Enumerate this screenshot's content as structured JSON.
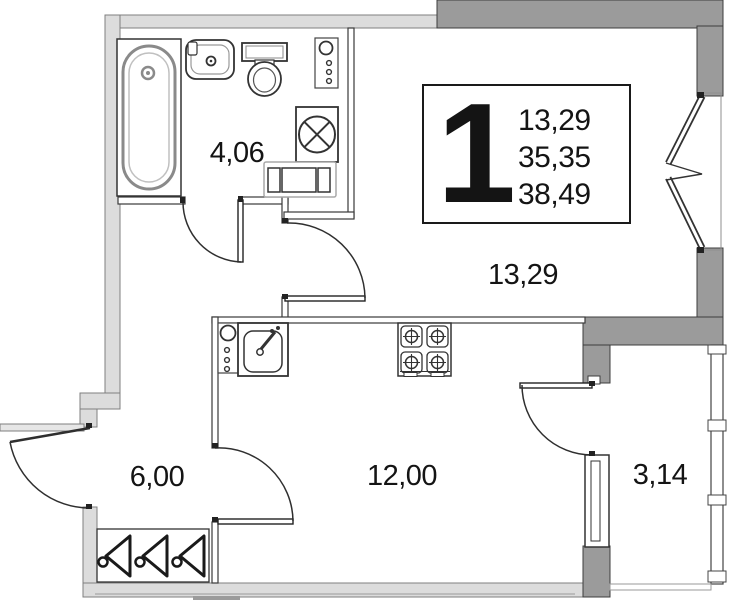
{
  "unit_card": {
    "rooms_count": "1",
    "living_area": "13,29",
    "area_no_balcony": "35,35",
    "total_area": "38,49"
  },
  "room_labels": {
    "bathroom": "4,06",
    "living": "13,29",
    "hall": "6,00",
    "kitchen": "12,00",
    "balcony": "3,14"
  },
  "colors": {
    "wall_light": "#dcdcdc",
    "wall_dark": "#9b9b9b",
    "line": "#2f2f2f",
    "text": "#141414"
  },
  "fixtures": [
    "bathtub",
    "washbasin",
    "toilet",
    "washing-machine",
    "bath-risers",
    "radiator-shelf",
    "kitchen-risers",
    "kitchen-sink",
    "stove",
    "wardrobe-hangers"
  ]
}
